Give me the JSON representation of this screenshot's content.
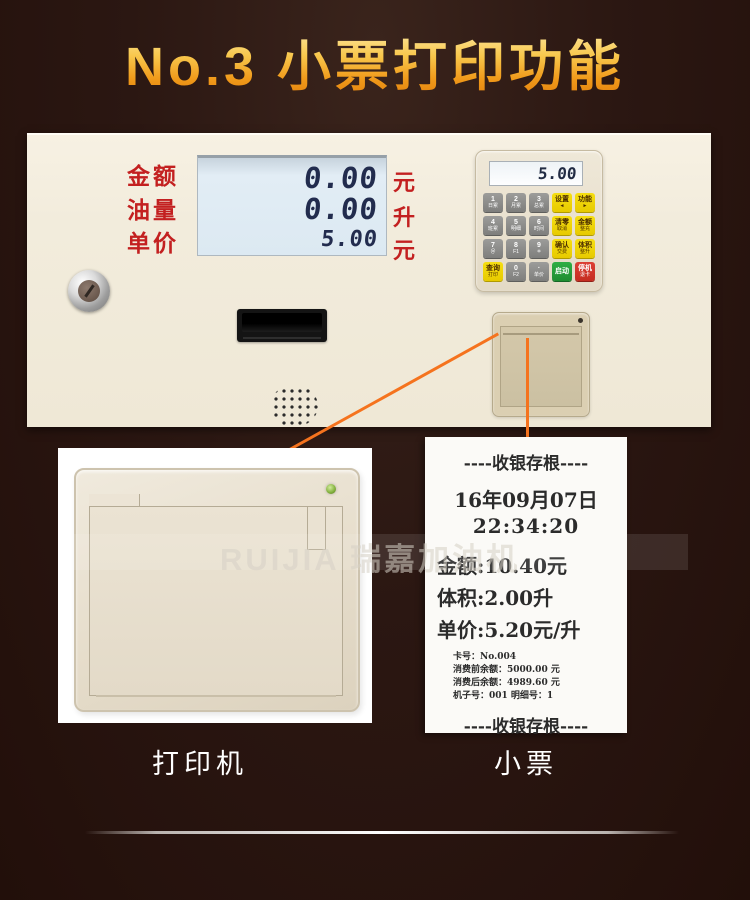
{
  "title": "No.3 小票打印功能",
  "panel": {
    "display": {
      "rows": [
        {
          "label": "金额",
          "value": "0.00",
          "unit": "元"
        },
        {
          "label": "油量",
          "value": "0.00",
          "unit": "升"
        },
        {
          "label": "单价",
          "value": "5.00",
          "unit": "元"
        }
      ]
    },
    "keypad": {
      "display_value": "5.00",
      "keys": [
        {
          "main": "1",
          "sub": "日累"
        },
        {
          "main": "2",
          "sub": "月累"
        },
        {
          "main": "3",
          "sub": "总累"
        },
        {
          "main": "设置",
          "sub": "◄"
        },
        {
          "main": "功能",
          "sub": "►"
        },
        {
          "main": "4",
          "sub": "班累"
        },
        {
          "main": "5",
          "sub": "明细"
        },
        {
          "main": "6",
          "sub": "时间"
        },
        {
          "main": "清零",
          "sub": "取消"
        },
        {
          "main": "金额",
          "sub": "整充"
        },
        {
          "main": "7",
          "sub": "＠"
        },
        {
          "main": "8",
          "sub": "F1"
        },
        {
          "main": "9",
          "sub": "＊"
        },
        {
          "main": "确认",
          "sub": "交费"
        },
        {
          "main": "体积",
          "sub": "整升"
        },
        {
          "main": "查询",
          "sub": "打印"
        },
        {
          "main": "0",
          "sub": "F2"
        },
        {
          "main": "·",
          "sub": "单价"
        },
        {
          "main": "启动",
          "sub": ""
        },
        {
          "main": "停机",
          "sub": "退卡"
        }
      ]
    }
  },
  "receipt": {
    "header": "----收银存根----",
    "date": "16年09月07日",
    "time": "22:34:20",
    "amount": "金额:10.40元",
    "volume": "体积:2.00升",
    "unit_price": "单价:5.20元/升",
    "details": [
      "卡号：No.004",
      "消费前余额：5000.00 元",
      "消费后余额：4989.60 元",
      "机子号：001  明细号：1"
    ],
    "footer": "----收银存根----"
  },
  "callouts": {
    "printer_label": "打印机",
    "receipt_label": "小票"
  },
  "watermark": "RUIJIA 瑞嘉加油机",
  "colors": {
    "background": "#2b1712",
    "title_gold": "#f8c84e",
    "panel_cream": "#f2ecdc",
    "lcd_blue": "#dce9f2",
    "label_red": "#c32020",
    "accent_orange": "#f5731e",
    "key_yellow": "#f1d600",
    "key_green": "#27a33c",
    "key_red": "#d4362a"
  }
}
